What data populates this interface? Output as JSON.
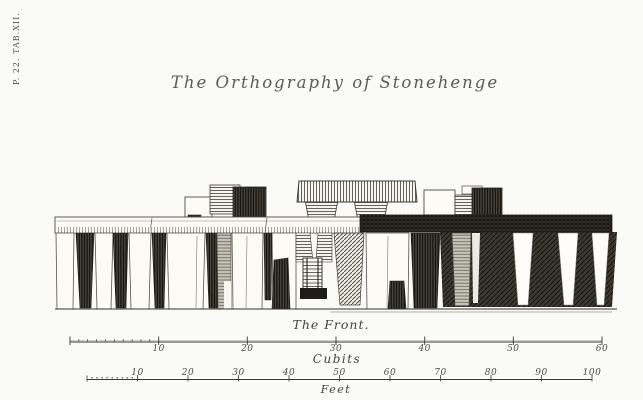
{
  "plate": {
    "label": "P. 22. TAB.XII."
  },
  "title": "The Orthography of Stonehenge",
  "drawing": {
    "caption": "The Front."
  },
  "scales": {
    "cubits": {
      "unit_label": "Cubits",
      "ticks": [
        "10",
        "20",
        "30",
        "40",
        "50",
        "60"
      ]
    },
    "feet": {
      "unit_label": "Feet",
      "ticks": [
        "10",
        "20",
        "30",
        "40",
        "50",
        "60",
        "70",
        "80",
        "90",
        "100"
      ]
    }
  },
  "colors": {
    "paper": "#fafaf6",
    "ink": "#2e2d2a",
    "text": "#4a4945"
  }
}
